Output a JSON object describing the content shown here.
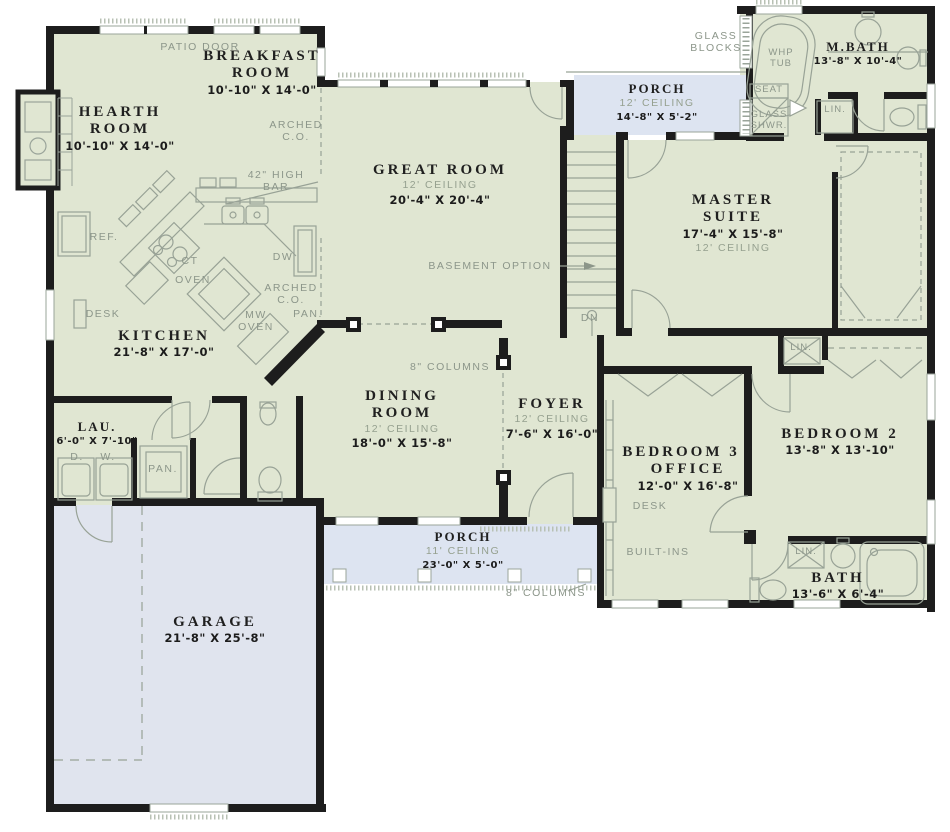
{
  "plan": {
    "colors": {
      "floor_green": "#e0e6d2",
      "porch_blue": "#dde4f1",
      "garage_blue": "#e0e4ee",
      "wall_black": "#1d1d1d",
      "annotation_gray": "#8c968a"
    },
    "rooms": {
      "hearth": {
        "name": "HEARTH ROOM",
        "dims": "10'-10\" X 14'-0\""
      },
      "breakfast": {
        "name": "BREAKFAST ROOM",
        "dims": "10'-10\" X 14'-0\""
      },
      "great": {
        "name": "GREAT ROOM",
        "ceiling": "12' CEILING",
        "dims": "20'-4\" X 20'-4\""
      },
      "porch_top": {
        "name": "PORCH",
        "ceiling": "12' CEILING",
        "dims": "14'-8\" X 5'-2\""
      },
      "mbath": {
        "name": "M.BATH",
        "dims": "13'-8\" X 10'-4\""
      },
      "master": {
        "name": "MASTER SUITE",
        "dims": "17'-4\" X 15'-8\"",
        "ceiling": "12' CEILING"
      },
      "kitchen": {
        "name": "KITCHEN",
        "dims": "21'-8\" X 17'-0\""
      },
      "dining": {
        "name": "DINING ROOM",
        "ceiling": "12' CEILING",
        "dims": "18'-0\" X 15'-8\""
      },
      "foyer": {
        "name": "FOYER",
        "ceiling": "12' CEILING",
        "dims": "7'-6\" X 16'-0\""
      },
      "laundry": {
        "name": "LAU.",
        "dims": "6'-0\" X 7'-10\""
      },
      "bed3": {
        "name": "BEDROOM 3 / OFFICE",
        "dims": "12'-0\" X 16'-8\""
      },
      "bed2": {
        "name": "BEDROOM 2",
        "dims": "13'-8\" X 13'-10\""
      },
      "bath": {
        "name": "BATH",
        "dims": "13'-6\" X 6'-4\""
      },
      "porch_bottom": {
        "name": "PORCH",
        "ceiling": "11' CEILING",
        "dims": "23'-0\" X 5'-0\""
      },
      "garage": {
        "name": "GARAGE",
        "dims": "21'-8\" X 25'-8\""
      }
    },
    "annotations": {
      "patio_door": "PATIO DOOR",
      "arched_co_top": "ARCHED C.O.",
      "high_bar": "42\" HIGH BAR",
      "glass_blocks": "GLASS BLOCKS",
      "whp_tub": "WHP TUB",
      "seat": "SEAT",
      "glass_shwr": "GLASS SHWR.",
      "lin_mbath": "LIN.",
      "basement_option": "BASEMENT OPTION",
      "down": "DN",
      "ref": "REF.",
      "cooktop": "CT",
      "oven": "OVEN",
      "dishwasher": "DW",
      "arched_co_kitchen": "ARCHED C.O.",
      "mw_oven": "MW OVEN",
      "pantry_kitchen": "PAN.",
      "desk_kitchen": "DESK",
      "columns_top": "8\" COLUMNS",
      "dryer": "D.",
      "washer": "W.",
      "pantry_laundry": "PAN.",
      "lin_hall": "LIN.",
      "desk_bed3": "DESK",
      "built_ins": "BUILT-INS",
      "lin_bath": "LIN.",
      "columns_bottom": "8\" COLUMNS"
    }
  }
}
